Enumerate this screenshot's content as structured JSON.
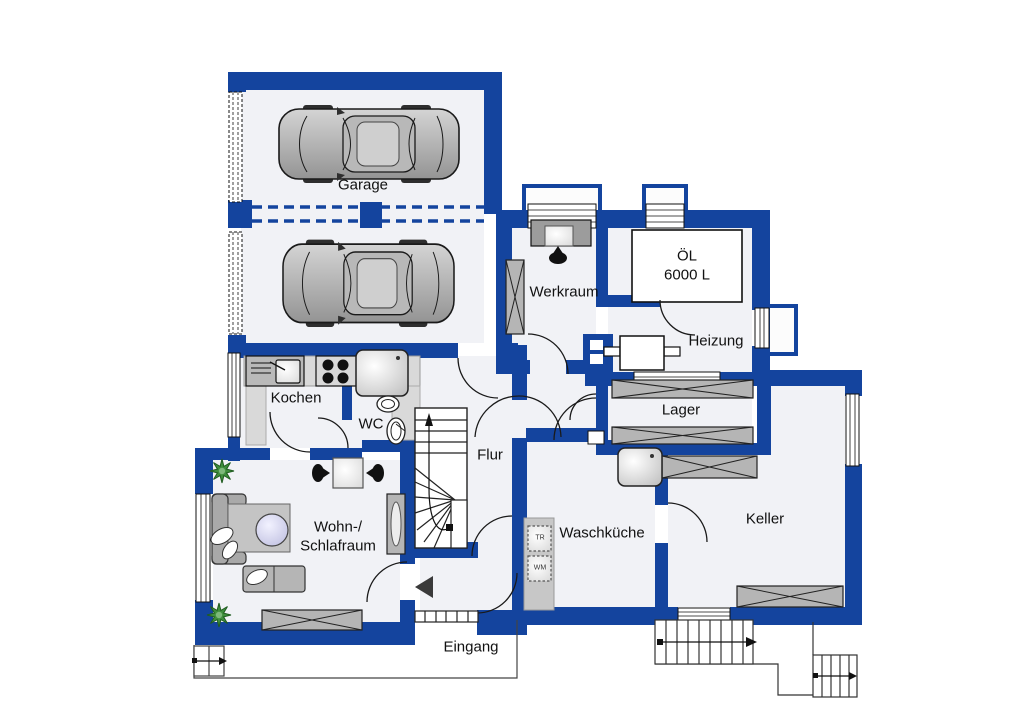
{
  "page": {
    "type": "residential-basement-floor-plan"
  },
  "rooms": {
    "garage": "Garage",
    "werkraum": "Werkraum",
    "heizung": "Heizung",
    "lager": "Lager",
    "keller": "Keller",
    "waschkueche": "Waschküche",
    "flur": "Flur",
    "kochen": "Kochen",
    "wc": "WC",
    "wohn_line1": "Wohn-/",
    "wohn_line2": "Schlafraum",
    "eingang": "Eingang"
  },
  "labels": {
    "oil_tank_line1": "ÖL",
    "oil_tank_line2": "6000 L",
    "dryer": "TR",
    "washer": "WM"
  },
  "icons": {
    "cars": "two cars top view in garage",
    "plants": "green plants in living room corners",
    "stairs": "winder staircase in hallway, exterior stairs bottom right"
  },
  "colors": {
    "wall_blue": "#14449e",
    "room_fill": "#f1f2f6",
    "furniture_gray": "#b5b5b5",
    "plant_green": "#3e8e3c",
    "table_lavender": "#d9d9f0"
  }
}
